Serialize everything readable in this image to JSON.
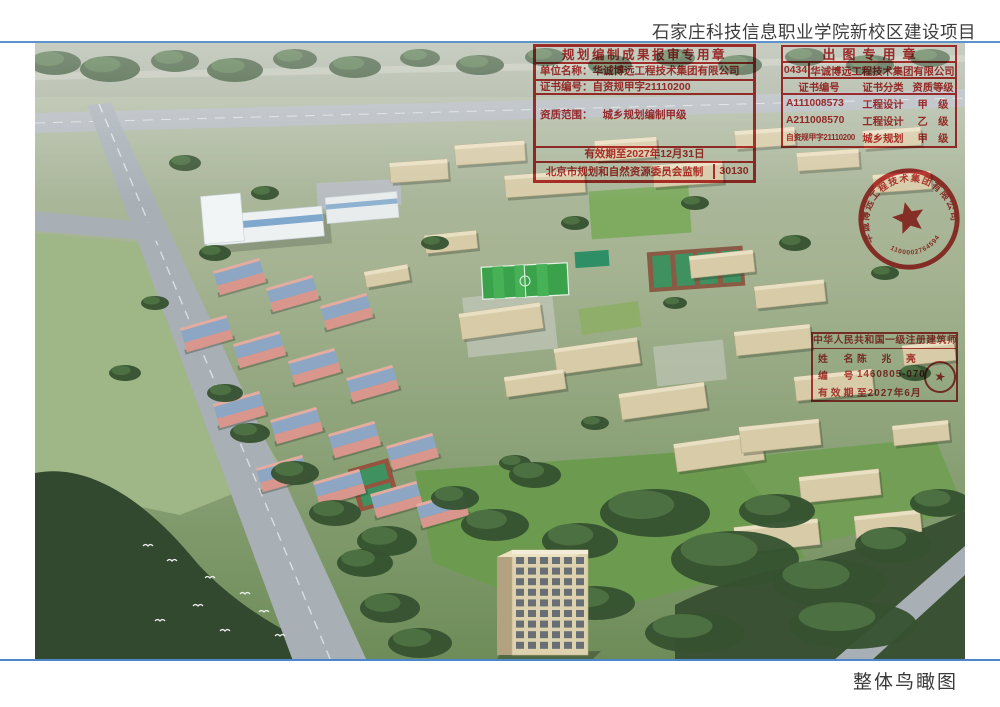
{
  "page": {
    "project_title": "石家庄科技信息职业学院新校区建设项目",
    "caption": "整体鸟瞰图"
  },
  "colors": {
    "stamp_red": "#c02525",
    "rule_blue": "#5d92cd"
  },
  "planning_stamp": {
    "title": "规划编制成果报审专用章",
    "unit_label": "单位名称：",
    "unit_value": "华诚博远工程技术集团有限公司",
    "cert_label": "证书编号：",
    "cert_value": "自资规甲字21110200",
    "scope_label": "资质范围：",
    "scope_value": "城乡规划编制甲级",
    "validity": "有效期至2027年12月31日",
    "issuer": "北京市规划和自然资源委员会监制",
    "serial": "30130"
  },
  "plot_stamp": {
    "title": "出图专用章",
    "code": "0434",
    "company": "华诚博远工程技术集团有限公司",
    "col_headers": [
      "证书编号",
      "证书分类",
      "资质等级"
    ],
    "rows": [
      {
        "cert_no": "A111008573",
        "category": "工程设计",
        "grade": "甲　级"
      },
      {
        "cert_no": "A211008570",
        "category": "工程设计",
        "grade": "乙　级"
      },
      {
        "cert_no": "自资规甲字21110200",
        "category": "城乡规划",
        "grade": "甲　级"
      }
    ]
  },
  "company_seal": {
    "arc_text": "华诚博远工程技术集团有限公司",
    "number": "1100002764594"
  },
  "architect_stamp": {
    "title": "中华人民共和国一级注册建筑师",
    "name_label": "姓　名",
    "name_value": "陈 兆 亮",
    "no_label": "编　号",
    "no_value": "1460805-070",
    "valid_label": "有效期",
    "valid_value": "至2027年6月",
    "star": "★"
  }
}
